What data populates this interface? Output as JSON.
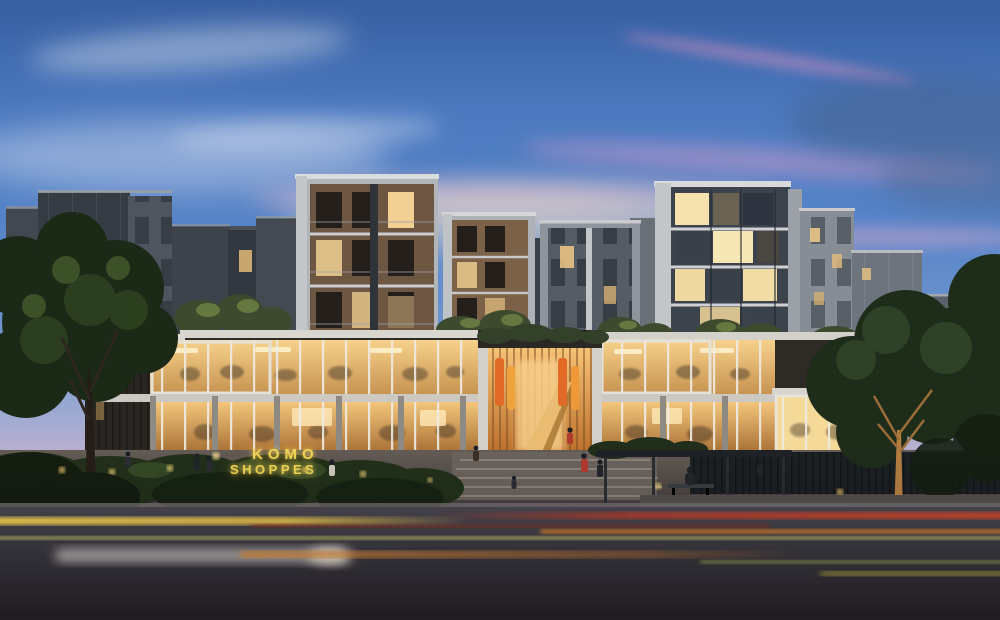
{
  "scene": {
    "label": "KOMO Shoppes mixed-use development, dusk architectural rendering",
    "sign": {
      "line1": "KOMO",
      "line2": "SHOPPES"
    },
    "colors": {
      "sky_top": "#3b66ae",
      "sky_blue": "#5584c8",
      "sky_pink": "#e7c3cd",
      "horizon_glow": "#f2d7c6",
      "facade_dark": "#353c44",
      "facade_light": "#b2b5b8",
      "wood_facade": "#6e5742",
      "retail_glow": "#f0c87e",
      "entrance_glow": "#f4b964",
      "banner_orange": "#e06a26",
      "sign_yellow": "#f0d656",
      "foliage_dark": "#1f2b1a",
      "road_asphalt": "#2e2c31",
      "trail_yellow": "#f5d14e",
      "trail_red": "#c43f28",
      "trail_orange": "#e08a3a",
      "trail_green": "#ccd06a",
      "uplit_trunk": "#b57f42"
    }
  }
}
